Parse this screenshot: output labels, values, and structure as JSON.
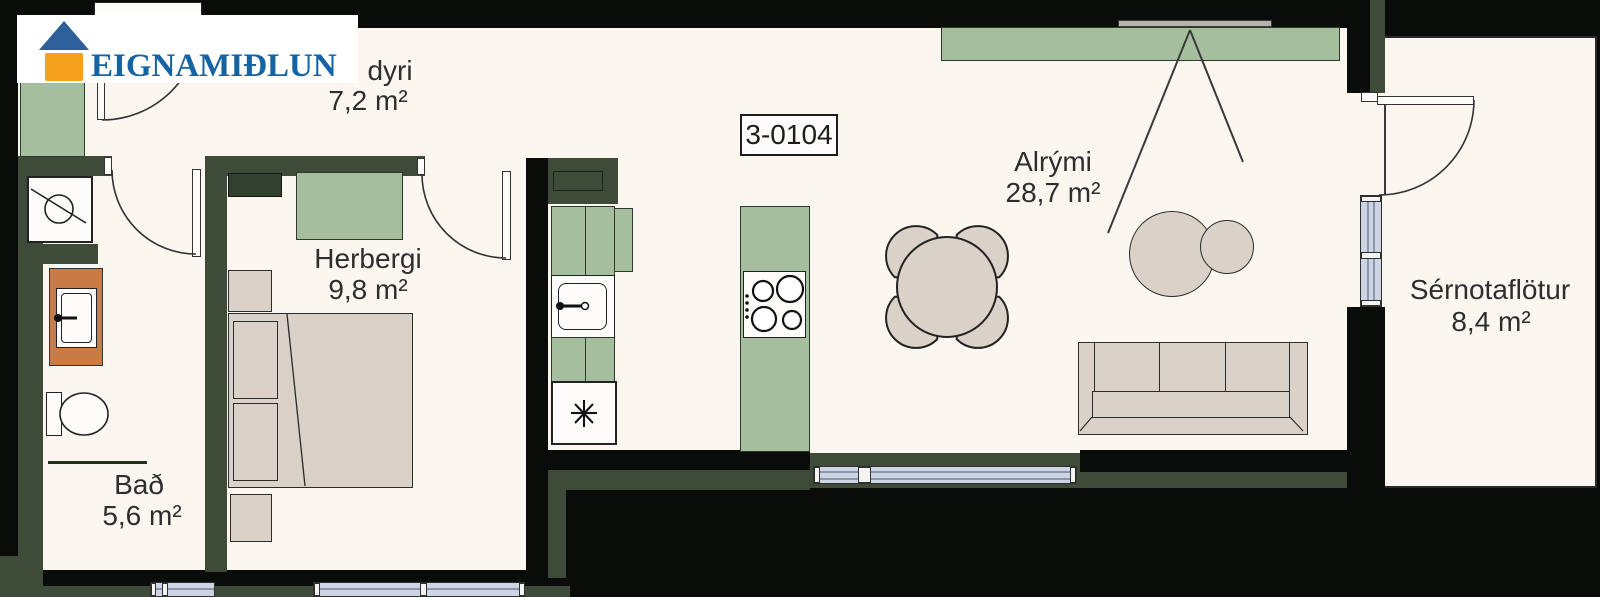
{
  "logo": {
    "brand": "EIGNAMIÐLUN"
  },
  "unit": {
    "label": "3-0104"
  },
  "rooms": {
    "anddyri": {
      "label": "dyri",
      "area": "7,2 m²"
    },
    "herbergi": {
      "label": "Herbergi",
      "area": "9,8 m²"
    },
    "bad": {
      "label": "Bað",
      "area": "5,6 m²"
    },
    "alrymi": {
      "label": "Alrými",
      "area": "28,7 m²"
    },
    "sernotaflotur": {
      "label": "Sérnotaflötur",
      "area": "8,4 m²"
    }
  },
  "colors": {
    "floor": "#FBF6F0",
    "outer_wall": "#0A0C09",
    "inner_wall_green": "#3E4B39",
    "furniture_green": "#A4BE9E",
    "furniture_beige": "#DAD1C9",
    "vanity_orange": "#C97B45",
    "window_glass": "#CDD5E4",
    "logo_blue": "#1563A3",
    "logo_orange": "#F6A11E",
    "label_text": "#2E2E2E"
  }
}
